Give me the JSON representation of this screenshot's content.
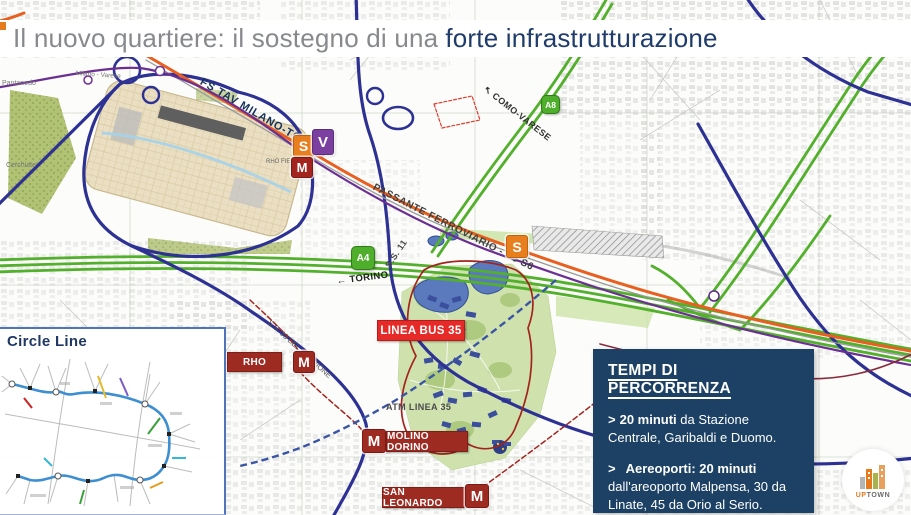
{
  "header": {
    "title_regular": "Il nuovo quartiere: il sostegno di una",
    "title_accent": "forte infrastrutturazione"
  },
  "map": {
    "road_labels": {
      "tav": "FS TAV MILANO-TORINO",
      "passante": "PASSANTE FERROVIARIO - S5 S6",
      "como_varese": "COMO-VARESE",
      "torino": "TORINO",
      "ss11": "S.S. 11",
      "ss33": "S.S. 33 DEL SEMPIONE",
      "atm": "ATM LINEA 35",
      "rho_fiera": "RHO FIERA",
      "pantanedo": "Pantanedo",
      "cerchiate": "Cerchiate",
      "milano_varese": "Milano - Varese"
    },
    "icons": {
      "arrow_nw": "↖",
      "arrow_left": "←"
    },
    "shields": {
      "a4": "A4",
      "a8": "A8"
    },
    "markers": {
      "s": "S",
      "v": "V",
      "m": "M"
    },
    "stations": {
      "rho": "RHO",
      "molino": "MOLINO DORINO",
      "san_leonardo": "SAN LEONARDO",
      "linea_bus": "LINEA BUS 35"
    },
    "colors": {
      "highway_blue": "#2d3193",
      "motorway_green": "#53b02c",
      "tav_orange": "#e85f1f",
      "passante_purple": "#6b2f93",
      "metro_red": "#a3241e",
      "bus_red": "#e52a28",
      "box_navy": "#1c4164",
      "accent_navy": "#1f3c6b"
    }
  },
  "inset": {
    "title": "Circle Line"
  },
  "travel_times": {
    "title": "TEMPI DI PERCORRENZA",
    "items": [
      {
        "prefix": ">",
        "bold": "20 minuti",
        "rest": "da Stazione Centrale, Garibaldi e Duomo."
      },
      {
        "prefix": ">",
        "bold": "Aereoporti: 20 minuti",
        "rest": "dall'areoporto Malpensa, 30 da Linate, 45 da Orio al Serio."
      }
    ]
  },
  "logo": {
    "up": "UP",
    "town": "TOWN"
  }
}
